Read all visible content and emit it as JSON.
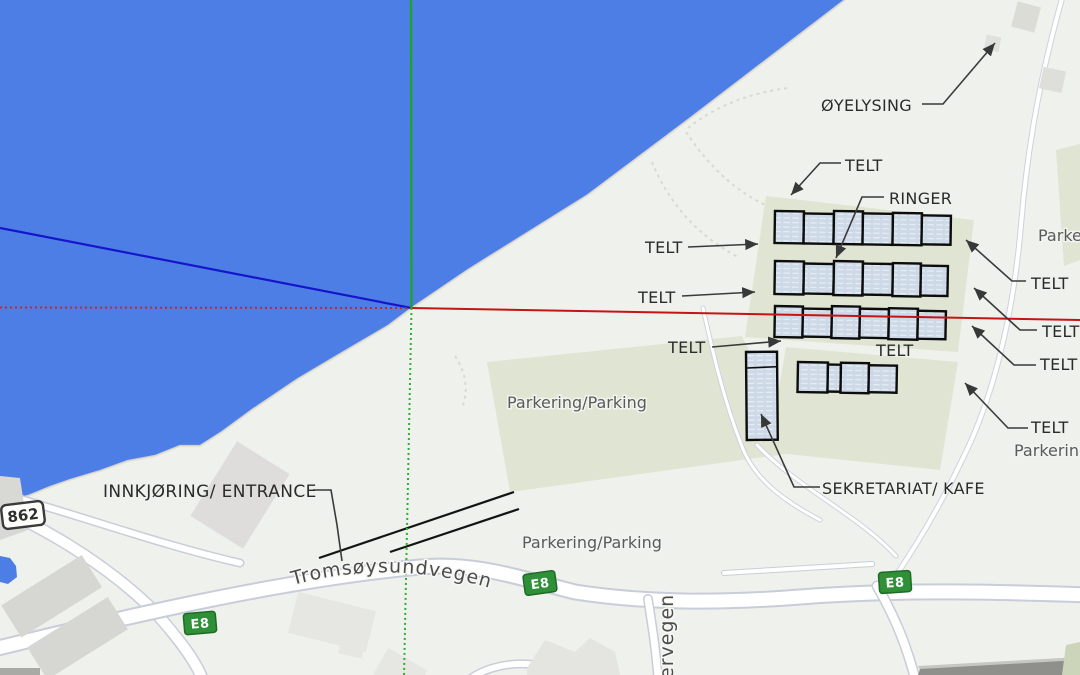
{
  "annotations": {
    "oyelysing": "ØYELYSING",
    "telt": "TELT",
    "ringer": "RINGER",
    "sekretariat_kafe": "SEKRETARIAT/ KAFE",
    "innkjoring_entrance": "INNKJØRING/ ENTRANCE"
  },
  "map_labels": {
    "parkering": "Parkering/Parking",
    "parkering_short": "Parkering",
    "tromsoysundvegen": "Tromsøysundvegen",
    "ervegen": "ervegen"
  },
  "badges": {
    "e8": "E8",
    "rv862": "862"
  },
  "colors": {
    "water": "#4d7ee5",
    "land": "#eff1ec",
    "parking_green": "#dfe5d2",
    "tent_fill": "#cdd9e7",
    "tent_stroke": "#0c0c0c",
    "axis_green": "#1ba51b",
    "axis_red": "#c41414",
    "axis_blue": "#1515cc",
    "badge_green": "#2f9038",
    "annotation_text": "#2b2b2b",
    "map_text": "#5a5a5a"
  }
}
